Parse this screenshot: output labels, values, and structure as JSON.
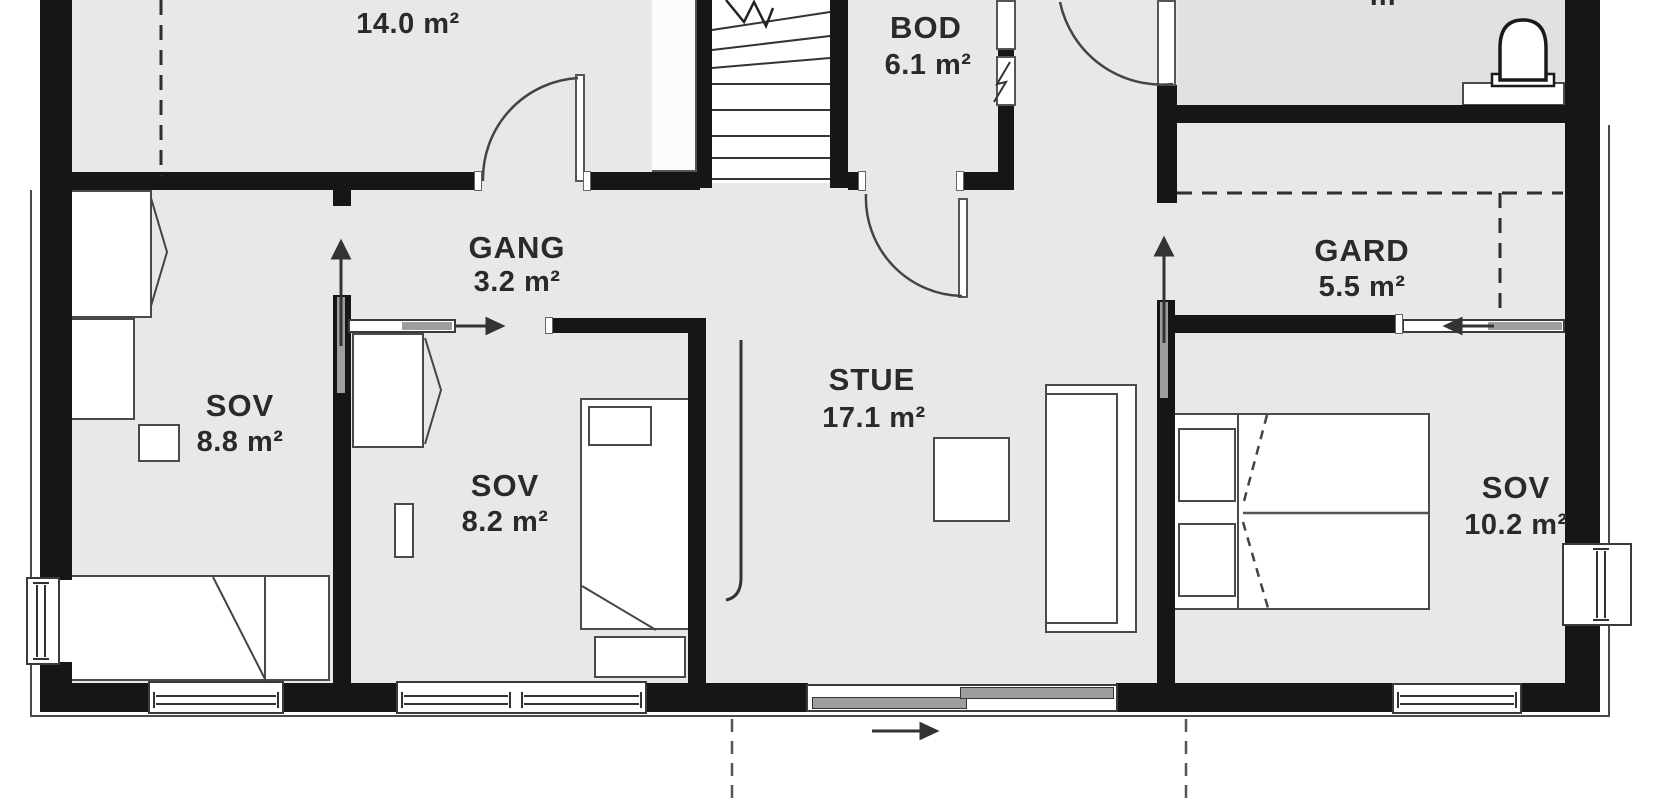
{
  "plan_title": "Floor plan",
  "rooms": {
    "bod14": {
      "name": "BOD",
      "area": "14.0 m²"
    },
    "bod61": {
      "name": "BOD",
      "area": "6.1 m²"
    },
    "bad": {
      "area_fragment": "m²"
    },
    "gang": {
      "name": "GANG",
      "area": "3.2 m²"
    },
    "gard": {
      "name": "GARD",
      "area": "5.5 m²"
    },
    "sov88": {
      "name": "SOV",
      "area": "8.8 m²"
    },
    "sov82": {
      "name": "SOV",
      "area": "8.2 m²"
    },
    "stue": {
      "name": "STUE",
      "area": "17.1 m²"
    },
    "sov102": {
      "name": "SOV",
      "area": "10.2 m²"
    }
  },
  "colors": {
    "wall": "#161616",
    "floor": "#e9e8e6",
    "bath_floor": "#e2e1df",
    "slide_panel": "#9e9e9e",
    "line": "#4a4a4a",
    "text": "#2a2a2a"
  }
}
